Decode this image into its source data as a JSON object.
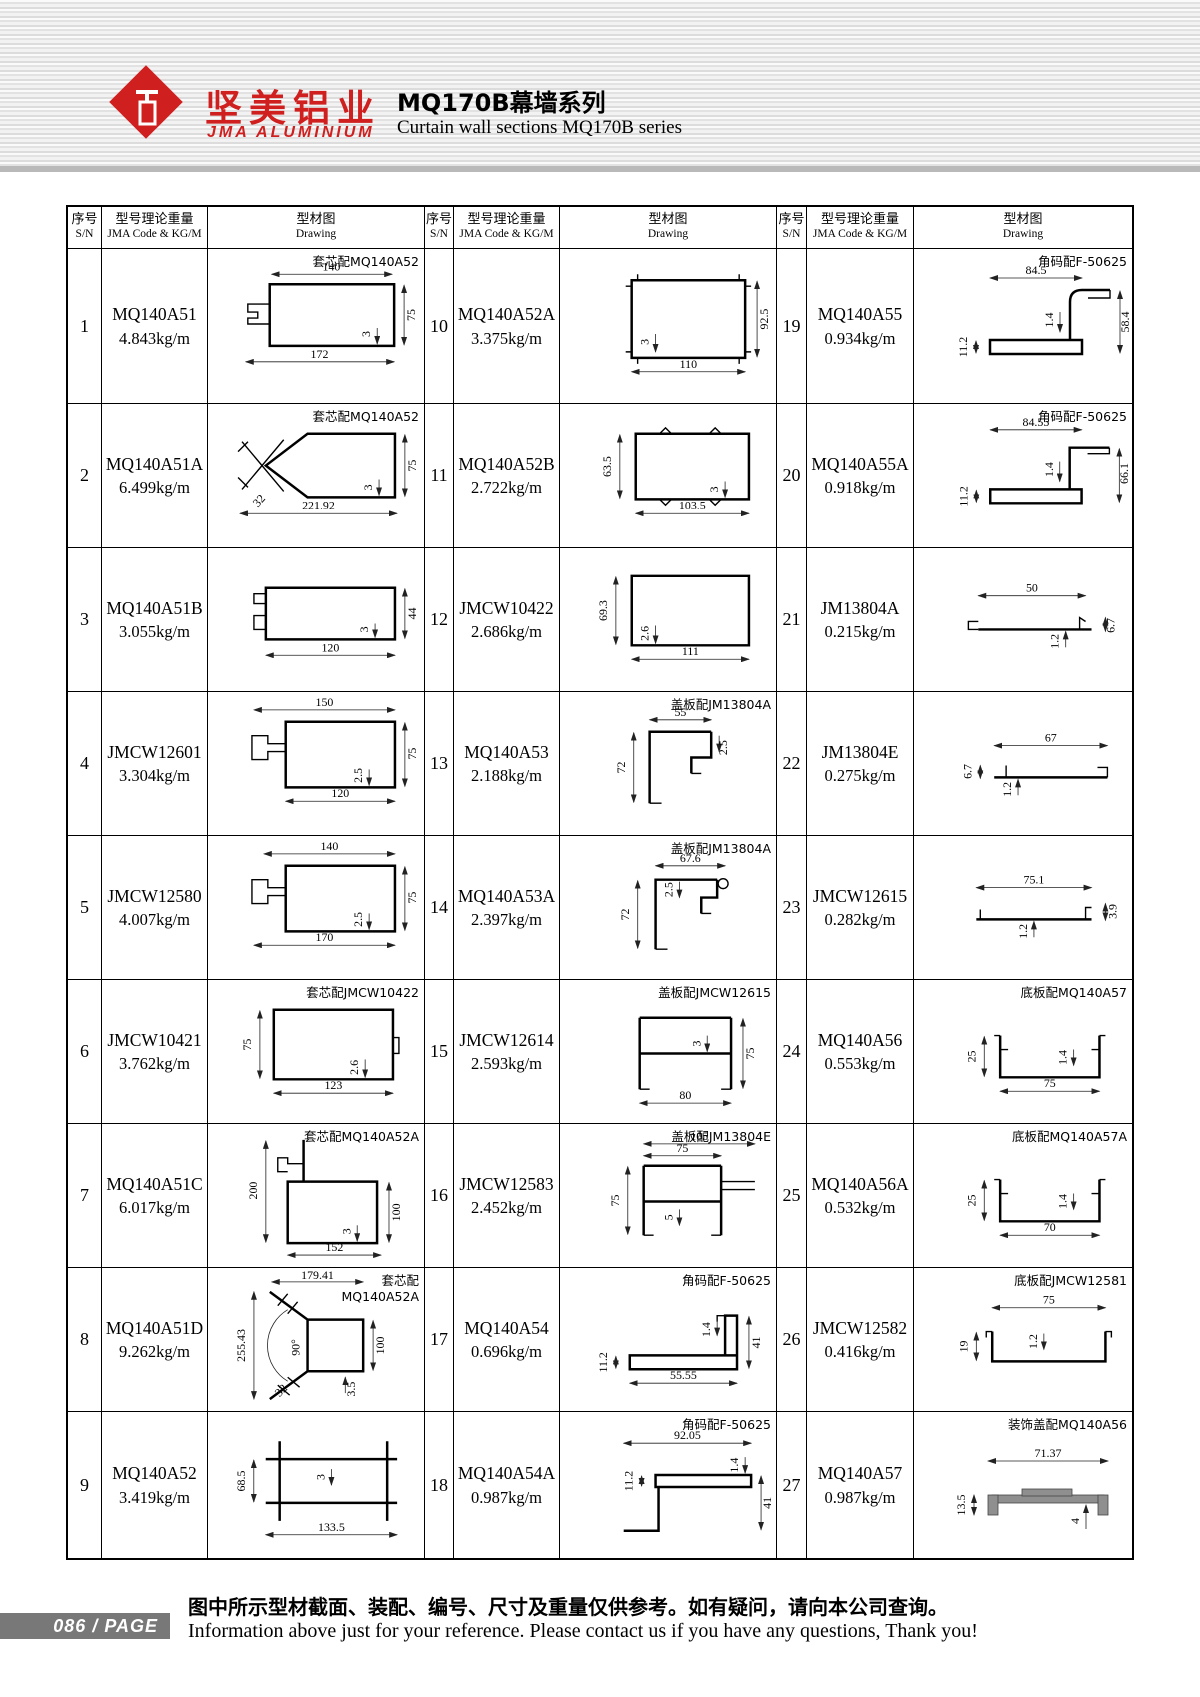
{
  "header": {
    "logo_cn": "坚美铝业",
    "logo_en": "JMA ALUMINIUM",
    "title_cn": "MQ170B幕墙系列",
    "title_en": "Curtain wall sections MQ170B series"
  },
  "table_head": {
    "sn_cn": "序号",
    "sn_en": "S/N",
    "code_cn": "型号理论重量",
    "code_en": "JMA Code & KG/M",
    "draw_cn": "型材图",
    "draw_en": "Drawing"
  },
  "entries": [
    {
      "sn": "1",
      "code": "MQ140A51",
      "weight": "4.843kg/m",
      "note": "套芯配MQ140A52",
      "dims": [
        "140",
        "75",
        "3",
        "172"
      ]
    },
    {
      "sn": "2",
      "code": "MQ140A51A",
      "weight": "6.499kg/m",
      "note": "套芯配MQ140A52",
      "dims": [
        "75",
        "3",
        "221.92",
        "32"
      ]
    },
    {
      "sn": "3",
      "code": "MQ140A51B",
      "weight": "3.055kg/m",
      "dims": [
        "44",
        "3",
        "120"
      ]
    },
    {
      "sn": "4",
      "code": "JMCW12601",
      "weight": "3.304kg/m",
      "dims": [
        "150",
        "75",
        "2.5",
        "120"
      ]
    },
    {
      "sn": "5",
      "code": "JMCW12580",
      "weight": "4.007kg/m",
      "dims": [
        "140",
        "75",
        "2.5",
        "170"
      ]
    },
    {
      "sn": "6",
      "code": "JMCW10421",
      "weight": "3.762kg/m",
      "note": "套芯配JMCW10422",
      "dims": [
        "75",
        "2.6",
        "123"
      ]
    },
    {
      "sn": "7",
      "code": "MQ140A51C",
      "weight": "6.017kg/m",
      "note": "套芯配MQ140A52A",
      "dims": [
        "200",
        "100",
        "3",
        "152"
      ]
    },
    {
      "sn": "8",
      "code": "MQ140A51D",
      "weight": "9.262kg/m",
      "note": "套芯配MQ140A52A",
      "dims": [
        "179.41",
        "255.43",
        "90°",
        "100",
        "3.5",
        "32"
      ]
    },
    {
      "sn": "9",
      "code": "MQ140A52",
      "weight": "3.419kg/m",
      "dims": [
        "68.5",
        "3",
        "133.5"
      ]
    },
    {
      "sn": "10",
      "code": "MQ140A52A",
      "weight": "3.375kg/m",
      "dims": [
        "92.5",
        "3",
        "110"
      ]
    },
    {
      "sn": "11",
      "code": "MQ140A52B",
      "weight": "2.722kg/m",
      "dims": [
        "63.5",
        "3",
        "103.5"
      ]
    },
    {
      "sn": "12",
      "code": "JMCW10422",
      "weight": "2.686kg/m",
      "dims": [
        "69.3",
        "2.6",
        "111"
      ]
    },
    {
      "sn": "13",
      "code": "MQ140A53",
      "weight": "2.188kg/m",
      "note": "盖板配JM13804A",
      "dims": [
        "55",
        "72",
        "2.5"
      ]
    },
    {
      "sn": "14",
      "code": "MQ140A53A",
      "weight": "2.397kg/m",
      "note": "盖板配JM13804A",
      "dims": [
        "67.6",
        "72",
        "2.5"
      ]
    },
    {
      "sn": "15",
      "code": "JMCW12614",
      "weight": "2.593kg/m",
      "note": "盖板配JMCW12615",
      "dims": [
        "3",
        "75",
        "80"
      ]
    },
    {
      "sn": "16",
      "code": "JMCW12583",
      "weight": "2.452kg/m",
      "note": "盖板配JM13804E",
      "dims": [
        "105",
        "75",
        "75",
        "5"
      ]
    },
    {
      "sn": "17",
      "code": "MQ140A54",
      "weight": "0.696kg/m",
      "note": "角码配F-50625",
      "dims": [
        "1.4",
        "41",
        "11.2",
        "55.55"
      ]
    },
    {
      "sn": "18",
      "code": "MQ140A54A",
      "weight": "0.987kg/m",
      "note": "角码配F-50625",
      "dims": [
        "92.05",
        "1.4",
        "11.2",
        "41"
      ]
    },
    {
      "sn": "19",
      "code": "MQ140A55",
      "weight": "0.934kg/m",
      "note": "角码配F-50625",
      "dims": [
        "84.5",
        "1.4",
        "58.4",
        "11.2"
      ]
    },
    {
      "sn": "20",
      "code": "MQ140A55A",
      "weight": "0.918kg/m",
      "note": "角码配F-50625",
      "dims": [
        "84.55",
        "1.4",
        "66.1",
        "11.2"
      ]
    },
    {
      "sn": "21",
      "code": "JM13804A",
      "weight": "0.215kg/m",
      "dims": [
        "50",
        "1.2",
        "6.7"
      ]
    },
    {
      "sn": "22",
      "code": "JM13804E",
      "weight": "0.275kg/m",
      "dims": [
        "67",
        "6.7",
        "1.2"
      ]
    },
    {
      "sn": "23",
      "code": "JMCW12615",
      "weight": "0.282kg/m",
      "dims": [
        "75.1",
        "3.9",
        "1.2"
      ]
    },
    {
      "sn": "24",
      "code": "MQ140A56",
      "weight": "0.553kg/m",
      "note": "底板配MQ140A57",
      "dims": [
        "25",
        "1.4",
        "75"
      ]
    },
    {
      "sn": "25",
      "code": "MQ140A56A",
      "weight": "0.532kg/m",
      "note": "底板配MQ140A57A",
      "dims": [
        "25",
        "1.4",
        "70"
      ]
    },
    {
      "sn": "26",
      "code": "JMCW12582",
      "weight": "0.416kg/m",
      "note": "底板配JMCW12581",
      "dims": [
        "75",
        "19",
        "1.2"
      ]
    },
    {
      "sn": "27",
      "code": "MQ140A57",
      "weight": "0.987kg/m",
      "note": "装饰盖配MQ140A56",
      "dims": [
        "71.37",
        "13.5",
        "4"
      ]
    }
  ],
  "footer": {
    "page": "086",
    "page_label": "/ PAGE",
    "note_cn": "图中所示型材截面、装配、编号、尺寸及重量仅供参考。如有疑问，请向本公司查询。",
    "note_en": "Information above just for your reference. Please contact us if you have any questions, Thank you!"
  }
}
